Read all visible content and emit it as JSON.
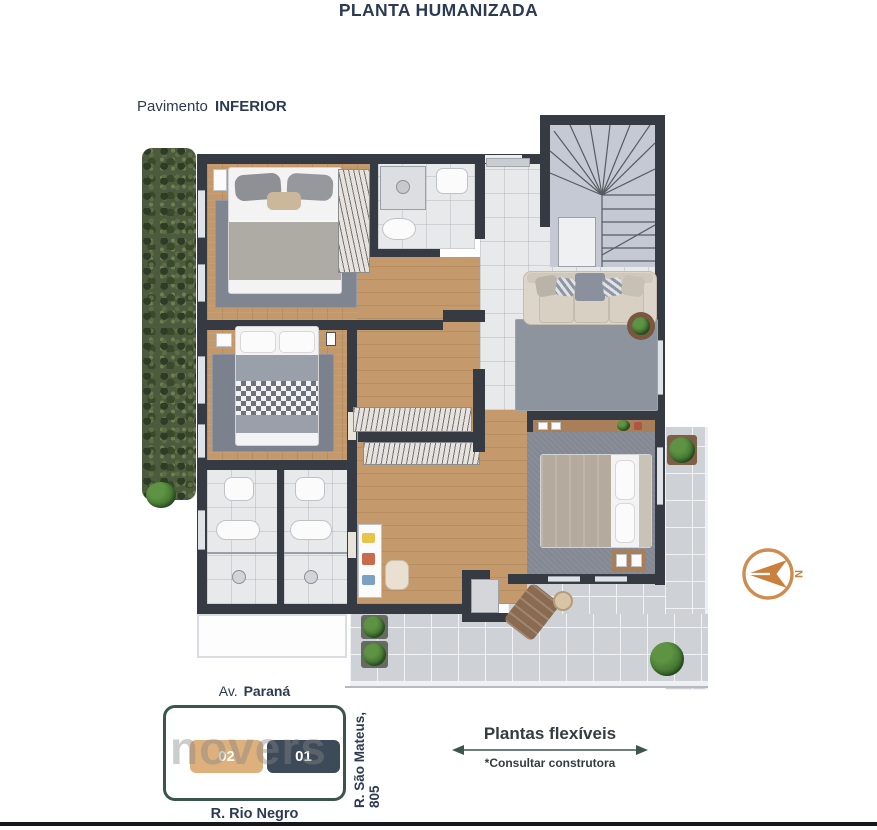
{
  "title": "PLANTA HUMANIZADA",
  "floor_label": {
    "prefix": "Pavimento",
    "value": "INFERIOR"
  },
  "compass": {
    "letter": "N",
    "icon": "north-arrow-icon",
    "color": "#c9803c"
  },
  "legend": {
    "label": "Plantas flexíveis",
    "note": "*Consultar construtora",
    "icon": "double-arrow-icon",
    "arrow_color": "#3c564d"
  },
  "map": {
    "street_top": {
      "prefix": "Av.",
      "value": "Paraná"
    },
    "street_bottom": "R. Rio Negro",
    "street_right": "R. São Mateus, 805",
    "units": [
      {
        "number": "02",
        "color": "#ddb07c"
      },
      {
        "number": "01",
        "color": "#3d4a59"
      }
    ],
    "watermark": "novers",
    "block_border_color": "#3a564b"
  },
  "palette": {
    "navy": "#2c3b52",
    "orange": "#c9803c",
    "wall": "#363b43",
    "wood": "#c3996c",
    "tile": "#e8e9eb",
    "terrace": "#ced1d6",
    "rug": "#868c97",
    "hedge_green": "#4c5a3d",
    "map_green": "#3a564b",
    "unit02_tan": "#ddb07c",
    "unit01_slate": "#3d4a59"
  }
}
